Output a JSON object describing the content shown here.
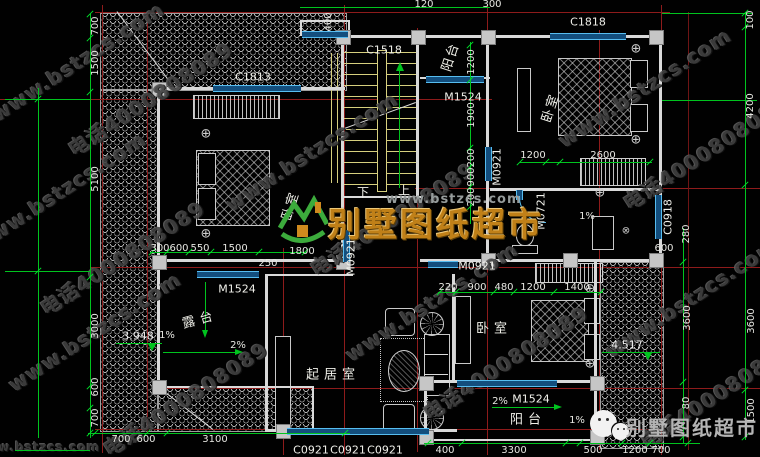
{
  "watermark": {
    "site": "www.bstzcs.com",
    "phone": "电话4000808089"
  },
  "logo": {
    "site": "www.bstzcs.com",
    "name": "别墅图纸超市"
  },
  "wechat": {
    "name": "别墅图纸超市"
  },
  "rooms": {
    "balcony_top": "阳台",
    "bedroom_top": "卧室",
    "bedroom_left": "卧室",
    "bedroom_bottom": "卧室",
    "living_room": "起居室",
    "terrace": "露台",
    "balcony_bottom": "阳台"
  },
  "stairs": {
    "down": "下",
    "up": "上"
  },
  "openings": {
    "c1518": "C1518",
    "c1818": "C1818",
    "c1813": "C1813",
    "c0918": "C0918",
    "c0921": "C0921",
    "m1524": "M1524",
    "m0921": "M0921",
    "m0721": "M0721"
  },
  "levels": {
    "terrace": "3.948",
    "roof": "4.517"
  },
  "slopes": {
    "p1": "1%",
    "p2": "2%"
  },
  "dims": {
    "left_outer": [
      "1500",
      "5100",
      "3000"
    ],
    "left_inner": [
      "700",
      "1500",
      "5100",
      "3000",
      "600",
      "700"
    ],
    "top": [
      "120",
      "300",
      "400"
    ],
    "right_outer": [
      "100",
      "4200",
      "3600",
      "1500"
    ],
    "right_inner": [
      "280",
      "600",
      "3600",
      "80"
    ],
    "bottom_left": [
      "700",
      "600",
      "3100"
    ],
    "bottom_right": [
      "400",
      "3300",
      "500",
      "1200",
      "700"
    ],
    "mid_row": [
      "300",
      "600",
      "550",
      "1500",
      "1800",
      "250"
    ],
    "bed_bottom_row": [
      "220",
      "900",
      "480",
      "1200",
      "1400"
    ],
    "bed_top_row": [
      "1200",
      "2600"
    ],
    "stair_col": [
      "1200",
      "1900",
      "200",
      "900",
      "200"
    ]
  }
}
